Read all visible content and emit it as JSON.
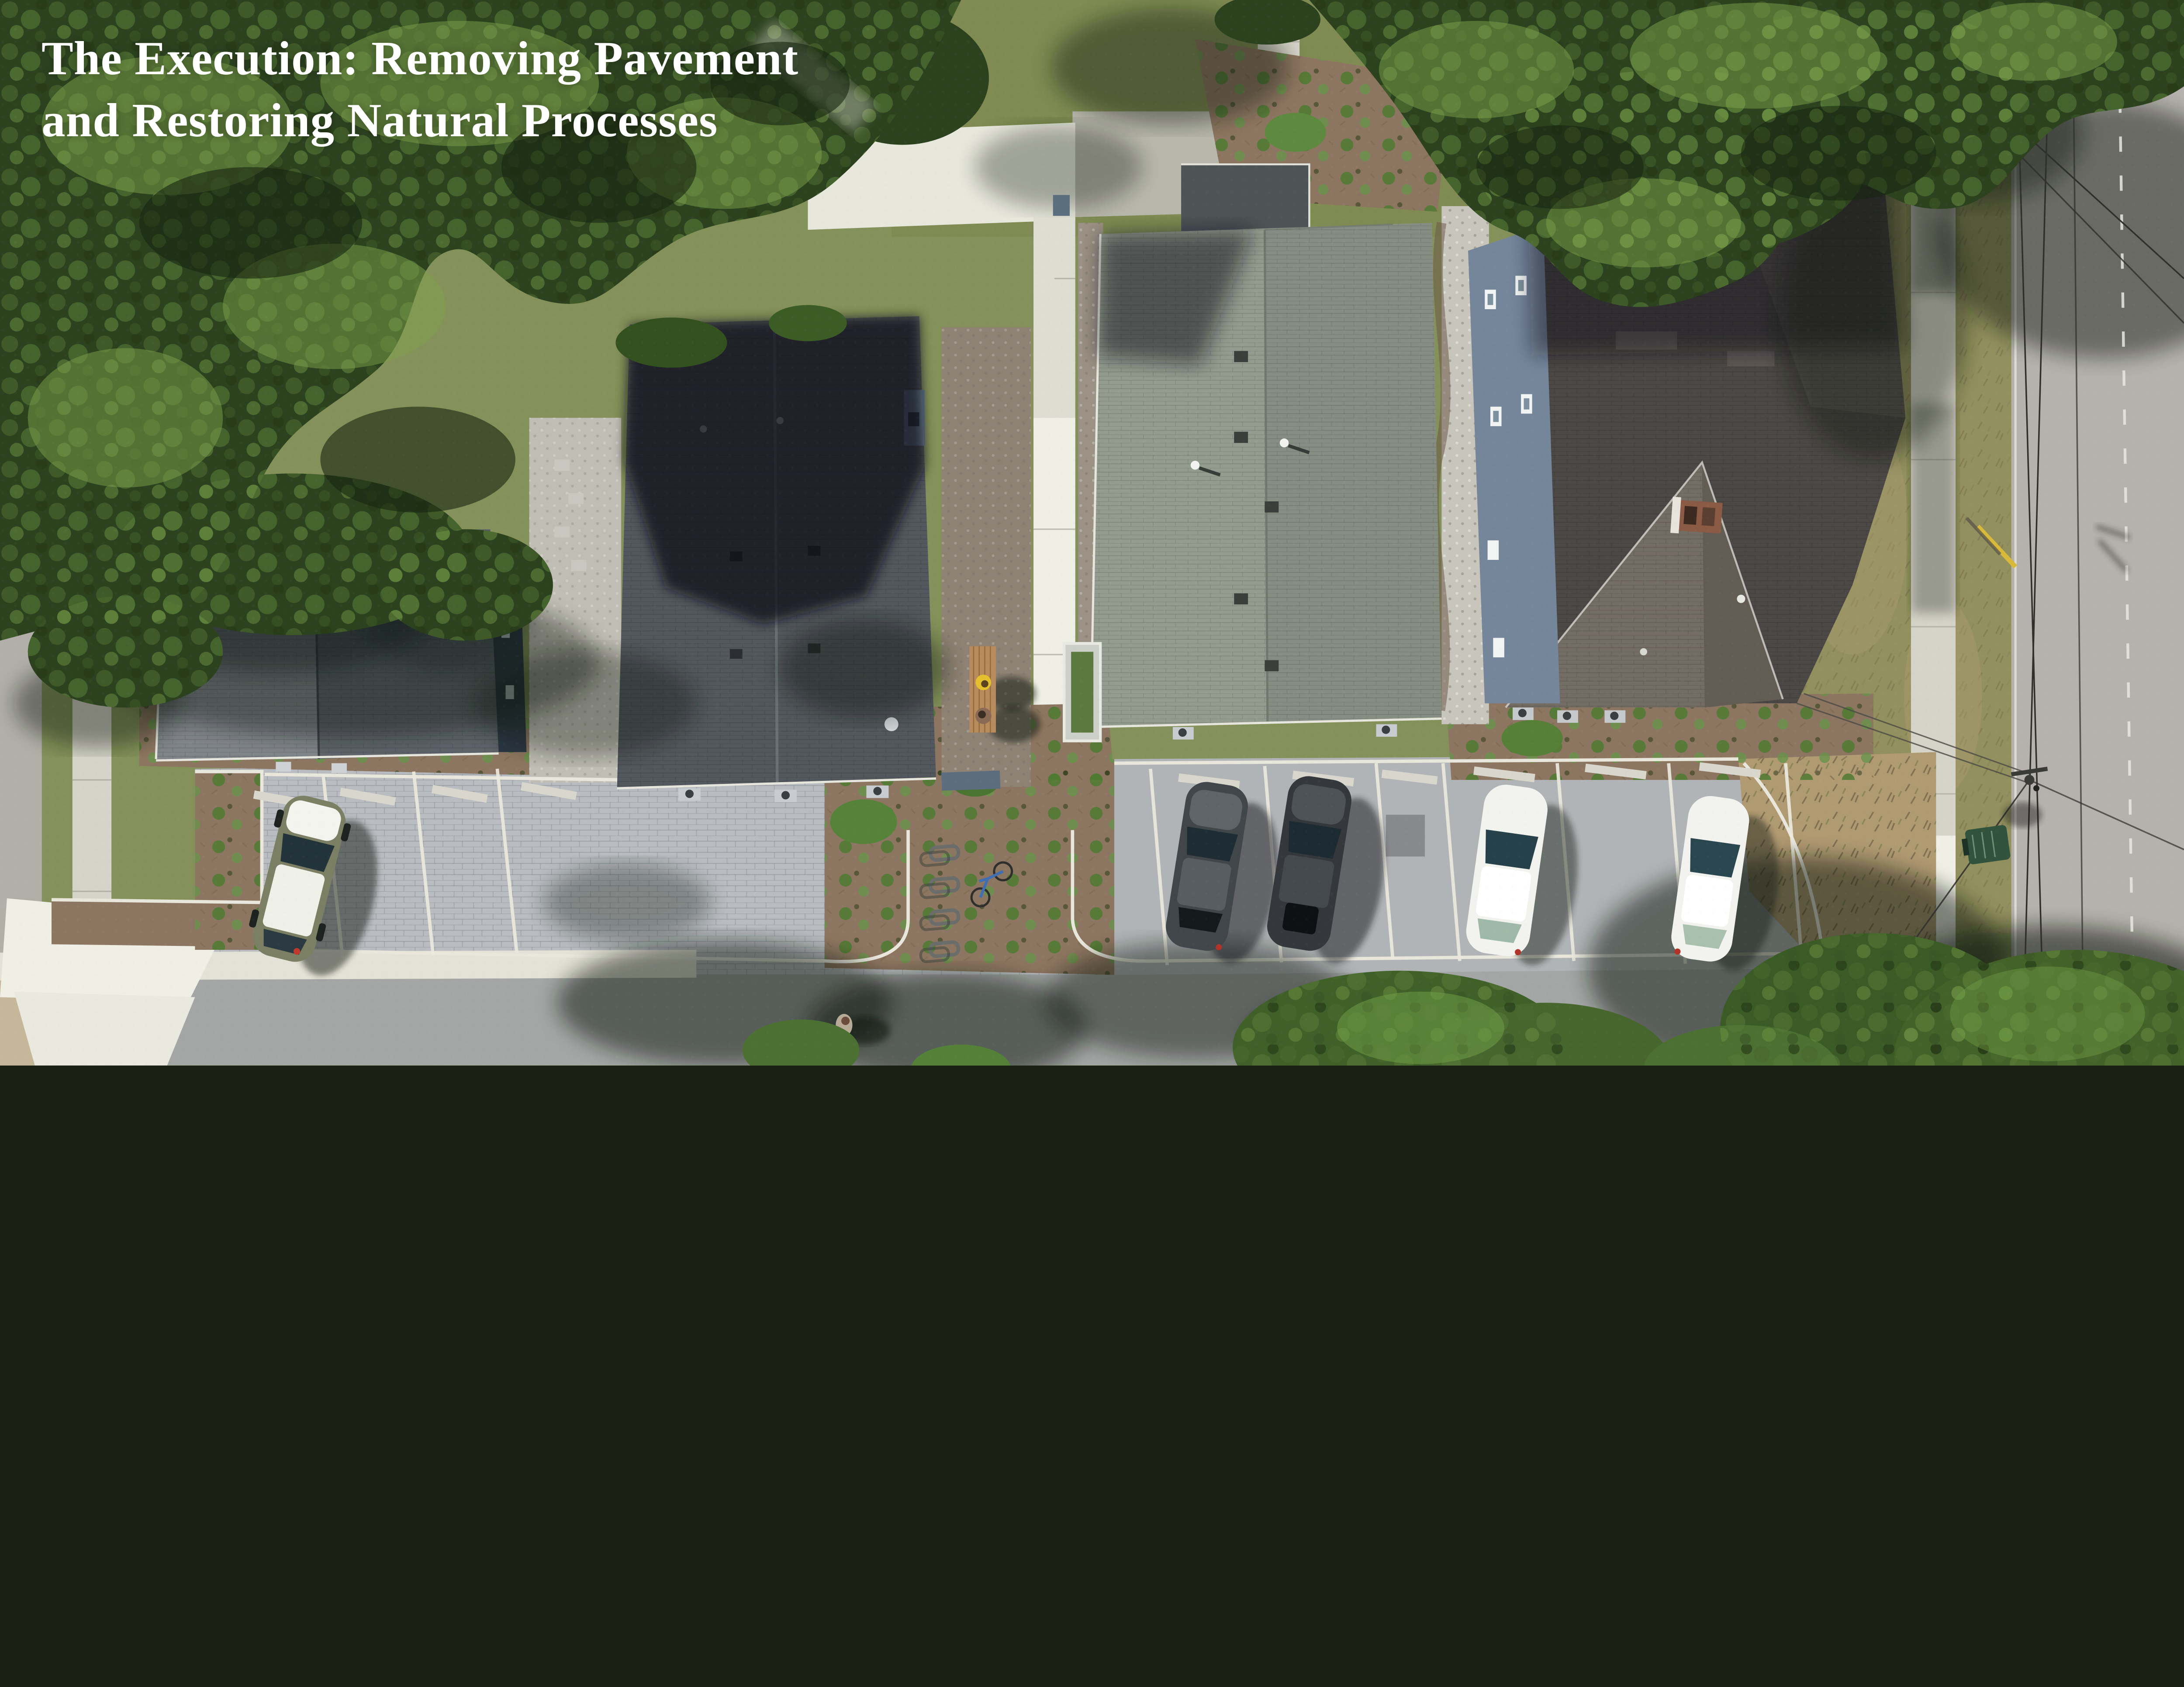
{
  "title": {
    "line1": "The Execution: Removing Pavement",
    "line2": "and Restoring Natural Processes",
    "color": "#ffffff"
  },
  "scene": {
    "description": "Top-down aerial drone photograph of four residential houses with native planting beds, permeable paver parking lot, concrete walkways, bike racks, a bench with two people, a pedestrian, parked cars, and a street with overhead power lines under large tree canopies",
    "houses": 4,
    "parked_cars": 5,
    "car_colors": [
      "olive-green with white glare",
      "dark gray",
      "dark gray",
      "white",
      "white"
    ],
    "bike_racks": 4,
    "bikes": 1,
    "people_on_bench": 2,
    "pedestrians": 1,
    "trash_bins": 1
  },
  "palette": {
    "canopy": "#2c421f",
    "canopyLeaf": "#4a6a2e",
    "canopyLight": "#7da24c",
    "lawn": "#84915a",
    "lawnTop": "#7f8b52",
    "dryLawn": "#92905e",
    "roadRight": "#b5b1ac",
    "roadLeft": "#b2afa9",
    "bottomPavement": "#a4a6a5",
    "pavers": "#b9bcc0",
    "asphalt": "#b1b4b6",
    "concrete": "#d6d4c8",
    "concreteBright": "#efefe5",
    "mulch": "#8d7661",
    "gravel": "#c8c5bc",
    "dirt": "#c6b79a",
    "roof1West": "#80858a",
    "roof1East": "#5f646b",
    "roof2": "#53585e",
    "roof3West": "#949c90",
    "roof3East": "#868e84",
    "roof4Dark": "#4c4845",
    "roof4PyramidSW": "#746d65",
    "roof4PyramidSE": "#625c55",
    "wallNavy": "#2c3743",
    "wallBlue": "#75869b",
    "brickChimney": "#8a5a44",
    "carOlive": "#7b7f63",
    "carDark1": "#41464b",
    "carDark2": "#34383c",
    "carWhite": "#f2f2ee",
    "binGreen": "#31523c",
    "benchWood": "#b88b5c",
    "personYellow": "#e4bf2e"
  }
}
